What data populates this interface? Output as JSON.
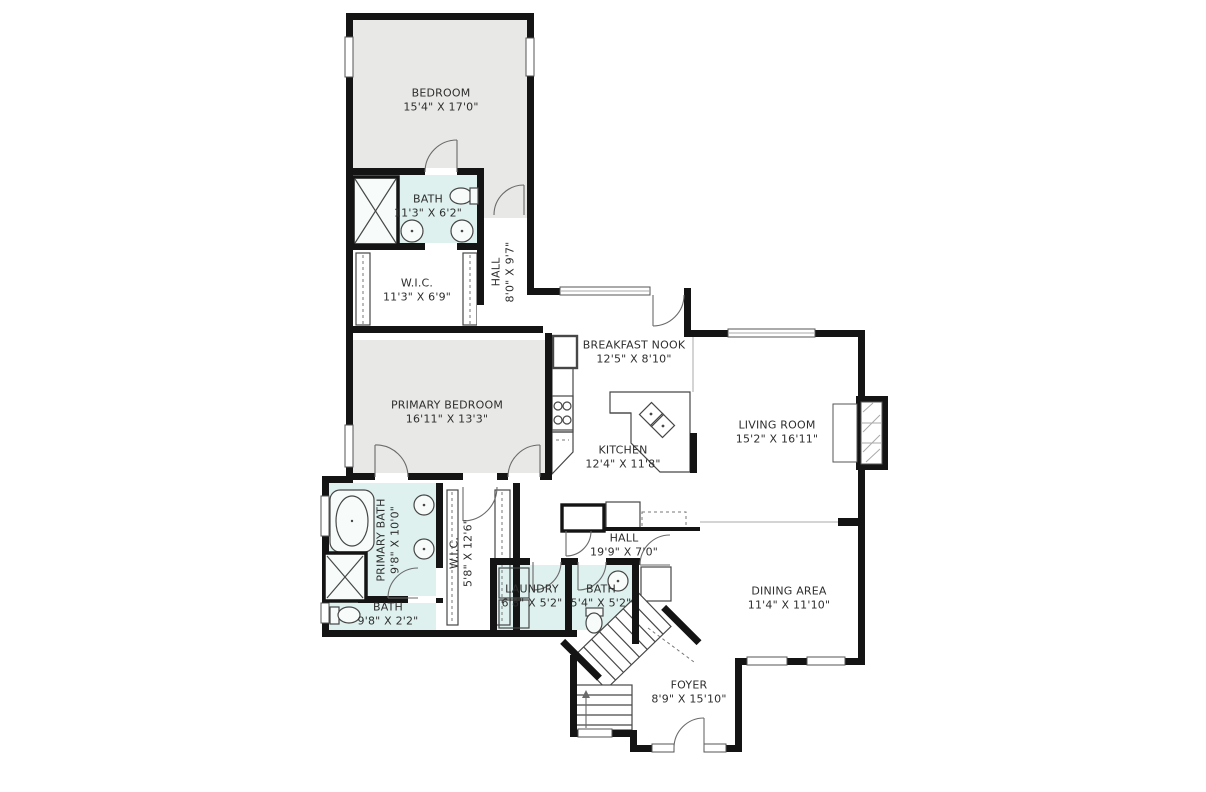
{
  "colors": {
    "wall": "#141414",
    "room_gray": "#e8e8e6",
    "room_blue": "#def1ee",
    "label_text": "#2e2e2e",
    "background": "#ffffff"
  },
  "rooms": [
    {
      "id": "bedroom",
      "name": "BEDROOM",
      "dims": "15'4\" X 17'0\""
    },
    {
      "id": "bath_upper",
      "name": "BATH",
      "dims": "11'3\" X 6'2\""
    },
    {
      "id": "wic_upper",
      "name": "W.I.C.",
      "dims": "11'3\" X 6'9\""
    },
    {
      "id": "hall_upper",
      "name": "HALL",
      "dims": "8'0\" X 9'7\""
    },
    {
      "id": "breakfast_nook",
      "name": "BREAKFAST NOOK",
      "dims": "12'5\" X 8'10\""
    },
    {
      "id": "primary_bedroom",
      "name": "PRIMARY BEDROOM",
      "dims": "16'11\" X 13'3\""
    },
    {
      "id": "kitchen",
      "name": "KITCHEN",
      "dims": "12'4\" X 11'8\""
    },
    {
      "id": "living_room",
      "name": "LIVING ROOM",
      "dims": "15'2\" X 16'11\""
    },
    {
      "id": "primary_bath",
      "name": "PRIMARY BATH",
      "dims": "9'8\" X 10'0\""
    },
    {
      "id": "wic_lower",
      "name": "W.I.C.",
      "dims": "5'8\" X 12'6\""
    },
    {
      "id": "bath_lower",
      "name": "BATH",
      "dims": "9'8\" X 2'2\""
    },
    {
      "id": "laundry",
      "name": "LAUNDRY",
      "dims": "6'8\" X 5'2\""
    },
    {
      "id": "bath_mid",
      "name": "BATH",
      "dims": "5'4\" X 5'2\""
    },
    {
      "id": "hall_lower",
      "name": "HALL",
      "dims": "19'9\" X 7'0\""
    },
    {
      "id": "dining_area",
      "name": "DINING AREA",
      "dims": "11'4\" X 11'10\""
    },
    {
      "id": "foyer",
      "name": "FOYER",
      "dims": "8'9\" X 15'10\""
    }
  ]
}
